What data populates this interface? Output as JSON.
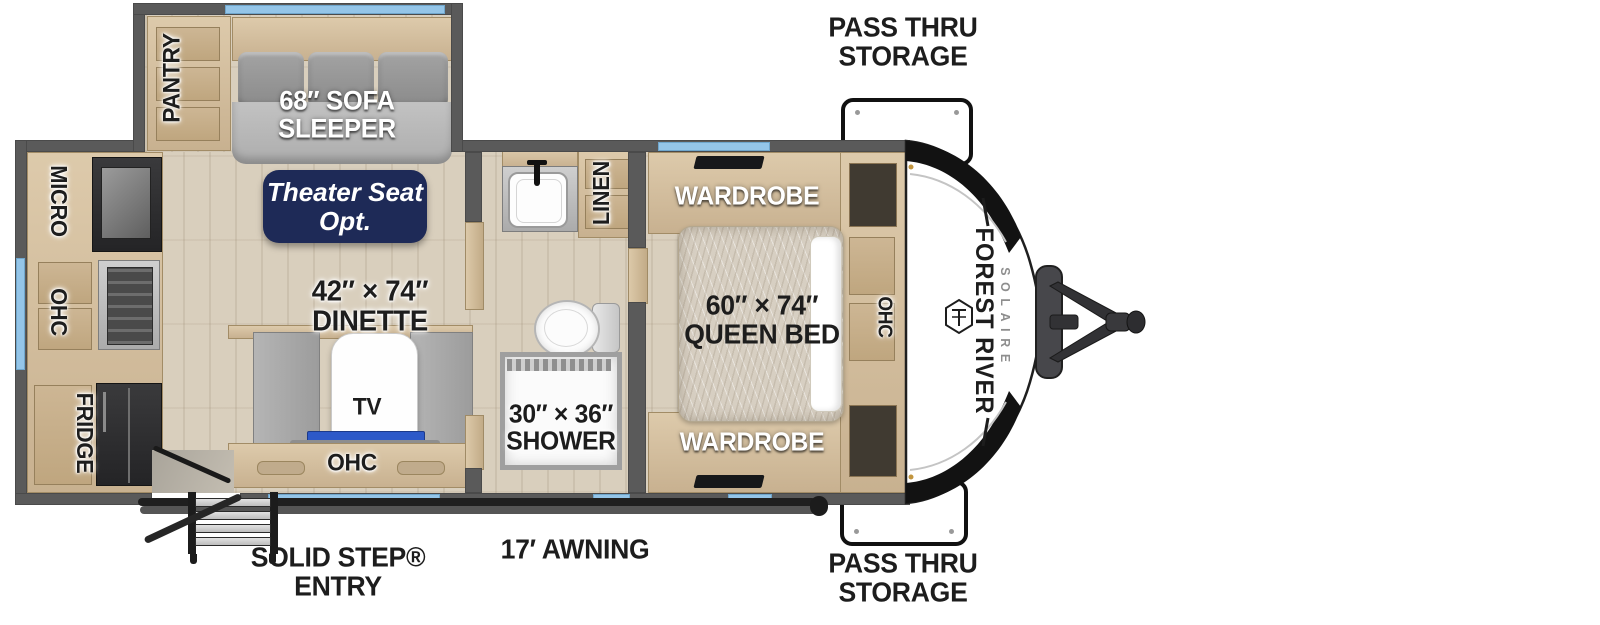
{
  "colors": {
    "wall": "#5a5a5a",
    "floor": "#d9cfbd",
    "wood": "#d3bf9f",
    "window": "#94c5e8",
    "navy_badge": "#1e2a57",
    "tv_bar": "#2d59c8",
    "sofa_gray": "#9a9a9a",
    "text_dark": "#1d1d1d"
  },
  "exterior": {
    "pass_thru_storage_top": {
      "line1": "PASS THRU",
      "line2": "STORAGE"
    },
    "pass_thru_storage_bottom": {
      "line1": "PASS THRU",
      "line2": "STORAGE"
    },
    "awning_label": "17′ AWNING",
    "entry_label": {
      "line1": "SOLID STEP®",
      "line2": "ENTRY"
    },
    "brand": {
      "name": "FOREST RIVER",
      "model": "SOLAIRE"
    }
  },
  "kitchen": {
    "micro_label": "MICRO",
    "ohc_label": "OHC",
    "fridge_label": "FRIDGE"
  },
  "living": {
    "pantry_label": "PANTRY",
    "sofa_label": {
      "line1": "68″ SOFA",
      "line2": "SLEEPER"
    },
    "theater_option_badge": {
      "line1": "Theater Seat",
      "line2": "Opt."
    },
    "dinette_label": {
      "line1": "42″ × 74″",
      "line2": "DINETTE"
    },
    "tv_label": "TV",
    "ohc_label": "OHC"
  },
  "bathroom": {
    "linen_label": "LINEN",
    "shower_label": {
      "line1": "30″ × 36″",
      "line2": "SHOWER"
    }
  },
  "bedroom": {
    "wardrobe_top_label": "WARDROBE",
    "wardrobe_bottom_label": "WARDROBE",
    "queen_bed_label": {
      "line1": "60″ × 74″",
      "line2": "QUEEN BED"
    },
    "ohc_label": "OHC"
  }
}
